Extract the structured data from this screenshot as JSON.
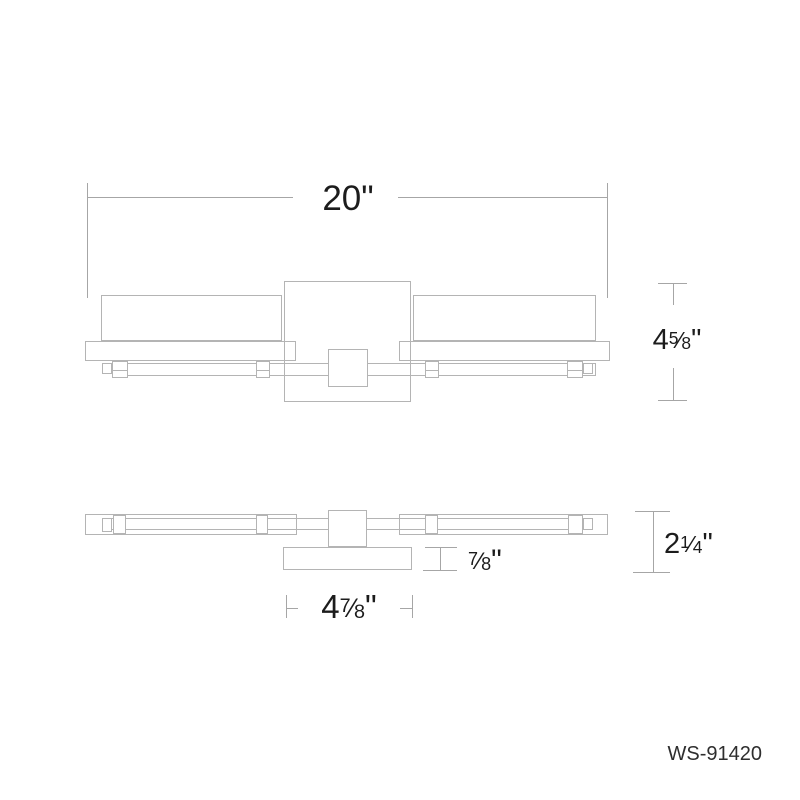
{
  "product": {
    "model": "WS-91420"
  },
  "dimensions": {
    "overall_width": {
      "whole": "20",
      "unit": "\""
    },
    "fixture_height": {
      "whole": "4",
      "num": "5",
      "slash": "⁄",
      "den": "8",
      "unit": "\""
    },
    "overall_depth": {
      "whole": "2",
      "num": "1",
      "slash": "⁄",
      "den": "4",
      "unit": "\""
    },
    "backplate_depth": {
      "whole": "",
      "num": "7",
      "slash": "⁄",
      "den": "8",
      "unit": "\""
    },
    "backplate_width": {
      "whole": "4",
      "num": "7",
      "slash": "⁄",
      "den": "8",
      "unit": "\""
    }
  },
  "colors": {
    "drawing_line": "#b4b4b4",
    "dimension_line": "#a6a6a6",
    "text": "#1c1c1c",
    "background": "#ffffff"
  }
}
